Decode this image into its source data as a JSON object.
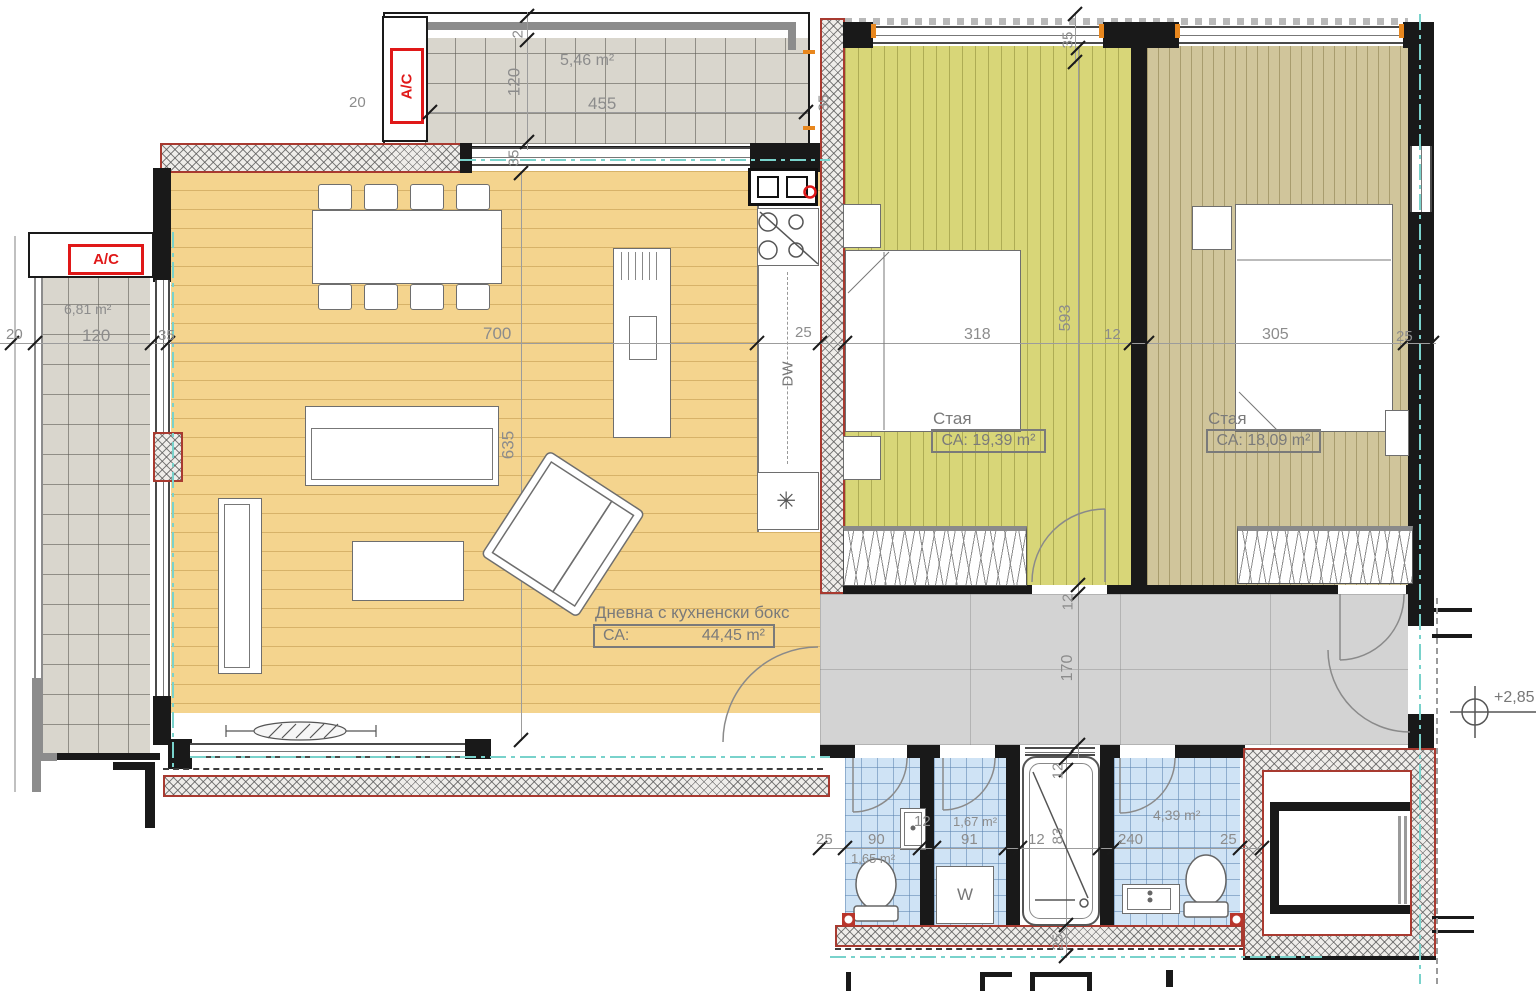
{
  "colors": {
    "wall_outline_red": "#a83a30",
    "ac_red": "#e01818",
    "axis_teal": "#79d2cb",
    "floor_living": "#f4d48e",
    "floor_bedroom1": "#d8d678",
    "floor_bedroom2": "#d0c59b",
    "tile_gray": "#d9d6cd",
    "tile_blue": "#cfe3f5",
    "corridor_gray": "#d3d3d3",
    "orange_mark": "#e8871e"
  },
  "rooms": {
    "living": {
      "name": "Дневна с кухненски бокс",
      "area_key": "СА:",
      "area_value": "44,45 m²"
    },
    "bedroom1": {
      "name": "Стая",
      "area": "СА: 19,39 m²"
    },
    "bedroom2": {
      "name": "Стая",
      "area": "СА: 18,09 m²"
    },
    "balcony_top": {
      "area": "5,46 m²"
    },
    "balcony_left": {
      "area": "6,81 m²"
    },
    "wc": {
      "area": "1,65 m²"
    },
    "laundry": {
      "area": "1,67 m²"
    },
    "bathroom": {
      "area": "4,39 m²"
    }
  },
  "equipment": {
    "ac": "A/C",
    "washer": "W",
    "dishwasher": "DW",
    "fridge_symbol": "✳"
  },
  "elevation": {
    "value": "+2,85"
  },
  "dims": {
    "balcony_top": {
      "w": "455",
      "d": "120",
      "t1": "20",
      "t2": "20"
    },
    "main_row": {
      "left_20": "20",
      "left_120": "120",
      "left_35": "35",
      "living_700": "700",
      "kitchen_25": "25",
      "bed1_318": "318",
      "wall_12": "12",
      "bed2_305": "305",
      "right_25": "25"
    },
    "vertical": {
      "living_635": "635",
      "living_top_35": "35",
      "kitchen_wall_35": "35",
      "top_right_35": "35",
      "bed1_593": "593",
      "corr_12": "12",
      "corr_170": "170",
      "tub_12": "12",
      "tub_83": "83",
      "bottom_25": "25"
    },
    "bath_row": {
      "wall_25": "25",
      "wc_90": "90",
      "wc_12": "12",
      "laundry_91": "91",
      "tubwall_12": "12",
      "bath_240": "240",
      "bath_25": "25"
    }
  }
}
